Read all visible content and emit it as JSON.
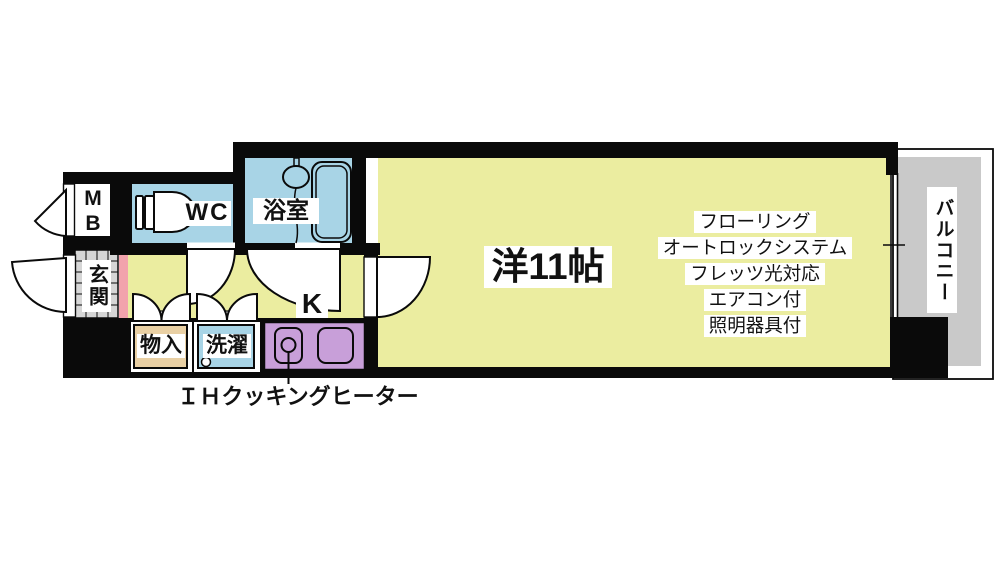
{
  "rooms": {
    "meter_box": "M\nB",
    "wc": "WC",
    "bathroom": "浴室",
    "entrance": "玄関",
    "storage": "物入",
    "laundry": "洗濯",
    "kitchen": "K",
    "main_room": "洋11帖",
    "balcony": "バルコニー"
  },
  "features": [
    "フローリング",
    "オートロックシステム",
    "フレッツ光対応",
    "エアコン付",
    "照明器具付"
  ],
  "annotations": {
    "ih_heater": "ＩＨクッキングヒーター"
  },
  "colors": {
    "wall": "#0a0a0a",
    "floor": "#ebeda0",
    "water": "#a8d4e6",
    "kitchen_counter": "#c89fd9",
    "storage_box": "#e9d0a4",
    "entrance_tile": "#d6d6d6",
    "balcony": "#c9c9c9",
    "step_pink": "#f2a3ac",
    "line": "#0a0a0a"
  }
}
